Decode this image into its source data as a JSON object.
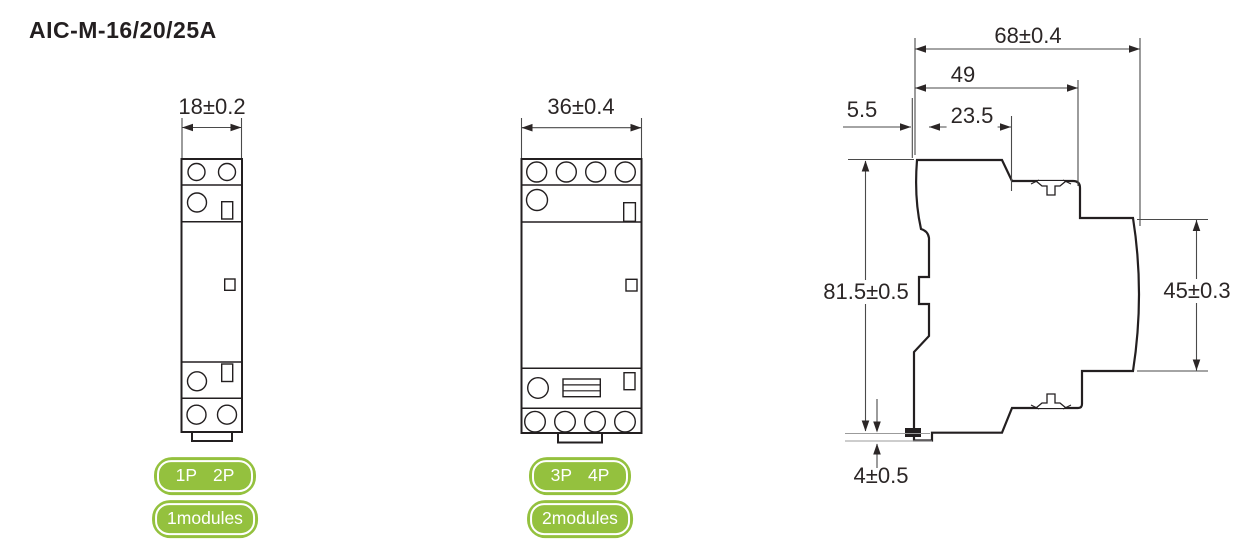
{
  "title": "AIC-M-16/20/25A",
  "colors": {
    "line": "#231f20",
    "dimension_line": "#4a4a4a",
    "badge_green": "#94c13e",
    "badge_text": "#ffffff"
  },
  "views": {
    "front_1module": {
      "width_dim": "18±0.2",
      "poles": [
        "1P",
        "2P"
      ],
      "modules_label": "1modules"
    },
    "front_2module": {
      "width_dim": "36±0.4",
      "poles": [
        "3P",
        "4P"
      ],
      "modules_label": "2modules"
    },
    "side": {
      "dims": {
        "total_depth": "68±0.4",
        "body_depth": "49",
        "front_lip": "5.5",
        "din_recess": "23.5",
        "total_height": "81.5±0.5",
        "din_height": "45±0.3",
        "bottom_clip": "4±0.5"
      }
    }
  }
}
